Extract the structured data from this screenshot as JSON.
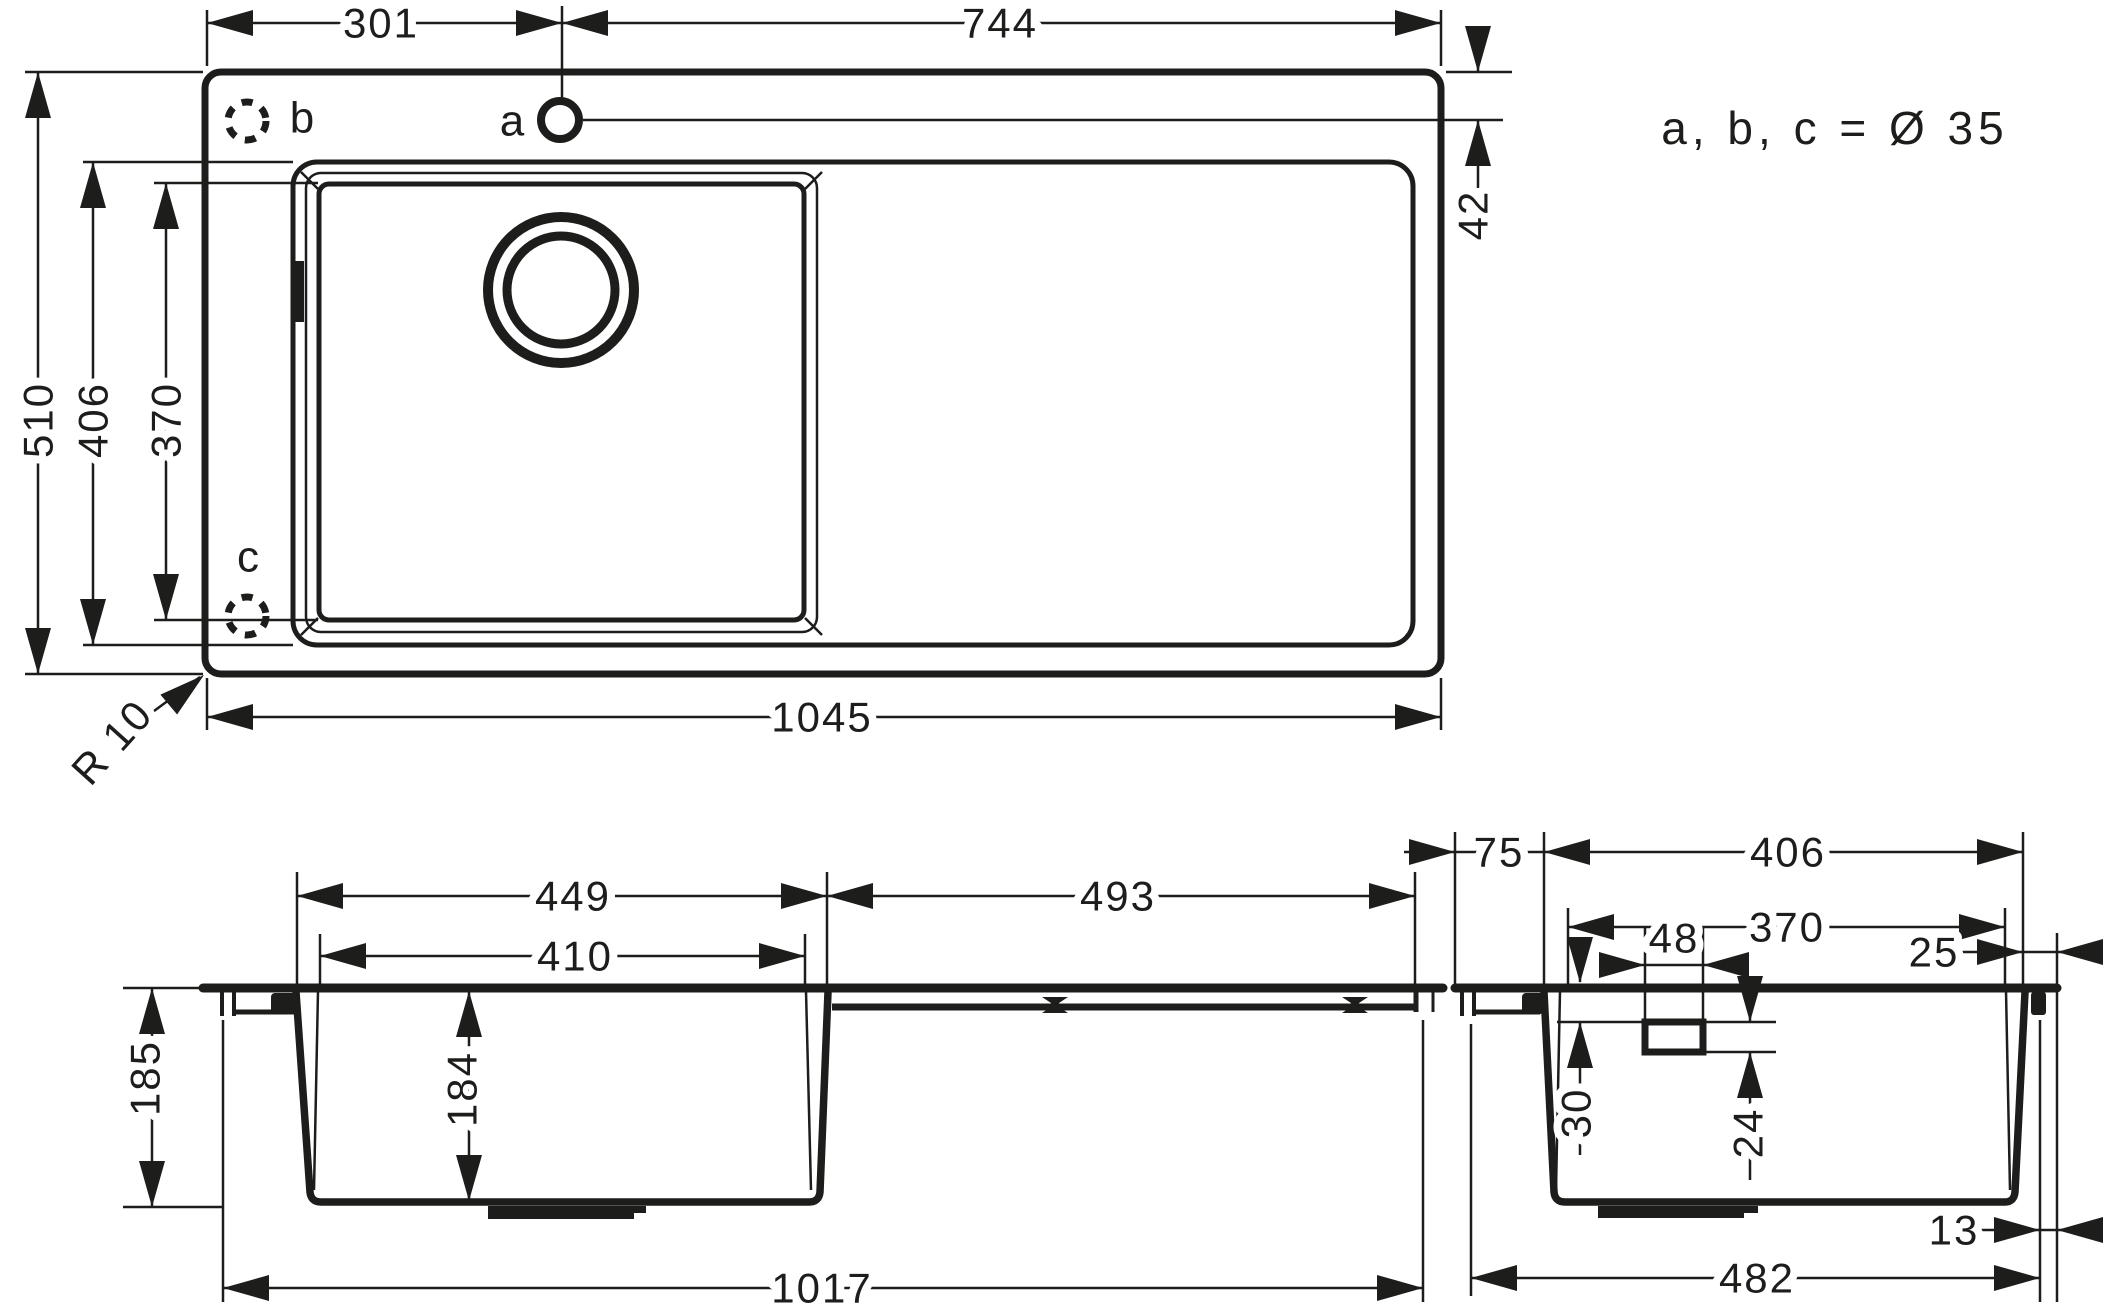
{
  "drawing": {
    "subject": "kitchen-sink-technical-dimension-drawing",
    "colors": {
      "line": "#1d1d1b",
      "background": "#ffffff"
    },
    "plan_view": {
      "holes_note": "a, b, c = Ø 35",
      "hole_a": "a",
      "hole_b": "b",
      "hole_c": "c",
      "dim_back_left": "301",
      "dim_back_right": "744",
      "dim_depth_overall": "510",
      "dim_recess_depth": "406",
      "dim_bowl_depth": "370",
      "dim_hole_centerline": "42",
      "dim_width_overall": "1045",
      "corner_radius": "R 10"
    },
    "front_view": {
      "dim_bowl_rim_width": "449",
      "dim_bowl_inner_width": "410",
      "dim_drainboard_width": "493",
      "dim_height_overall": "185",
      "dim_bowl_inner_depth": "184",
      "dim_body_width": "1017"
    },
    "side_view": {
      "dim_back_ledge": "75",
      "dim_recess_width": "406",
      "dim_bowl_inner_width": "370",
      "dim_overflow_width": "48",
      "dim_front_ledge": "25",
      "dim_overflow_top_offset": "30",
      "dim_overflow_height": "24",
      "dim_bottom_edge_offset": "13",
      "dim_body_depth": "482"
    }
  }
}
